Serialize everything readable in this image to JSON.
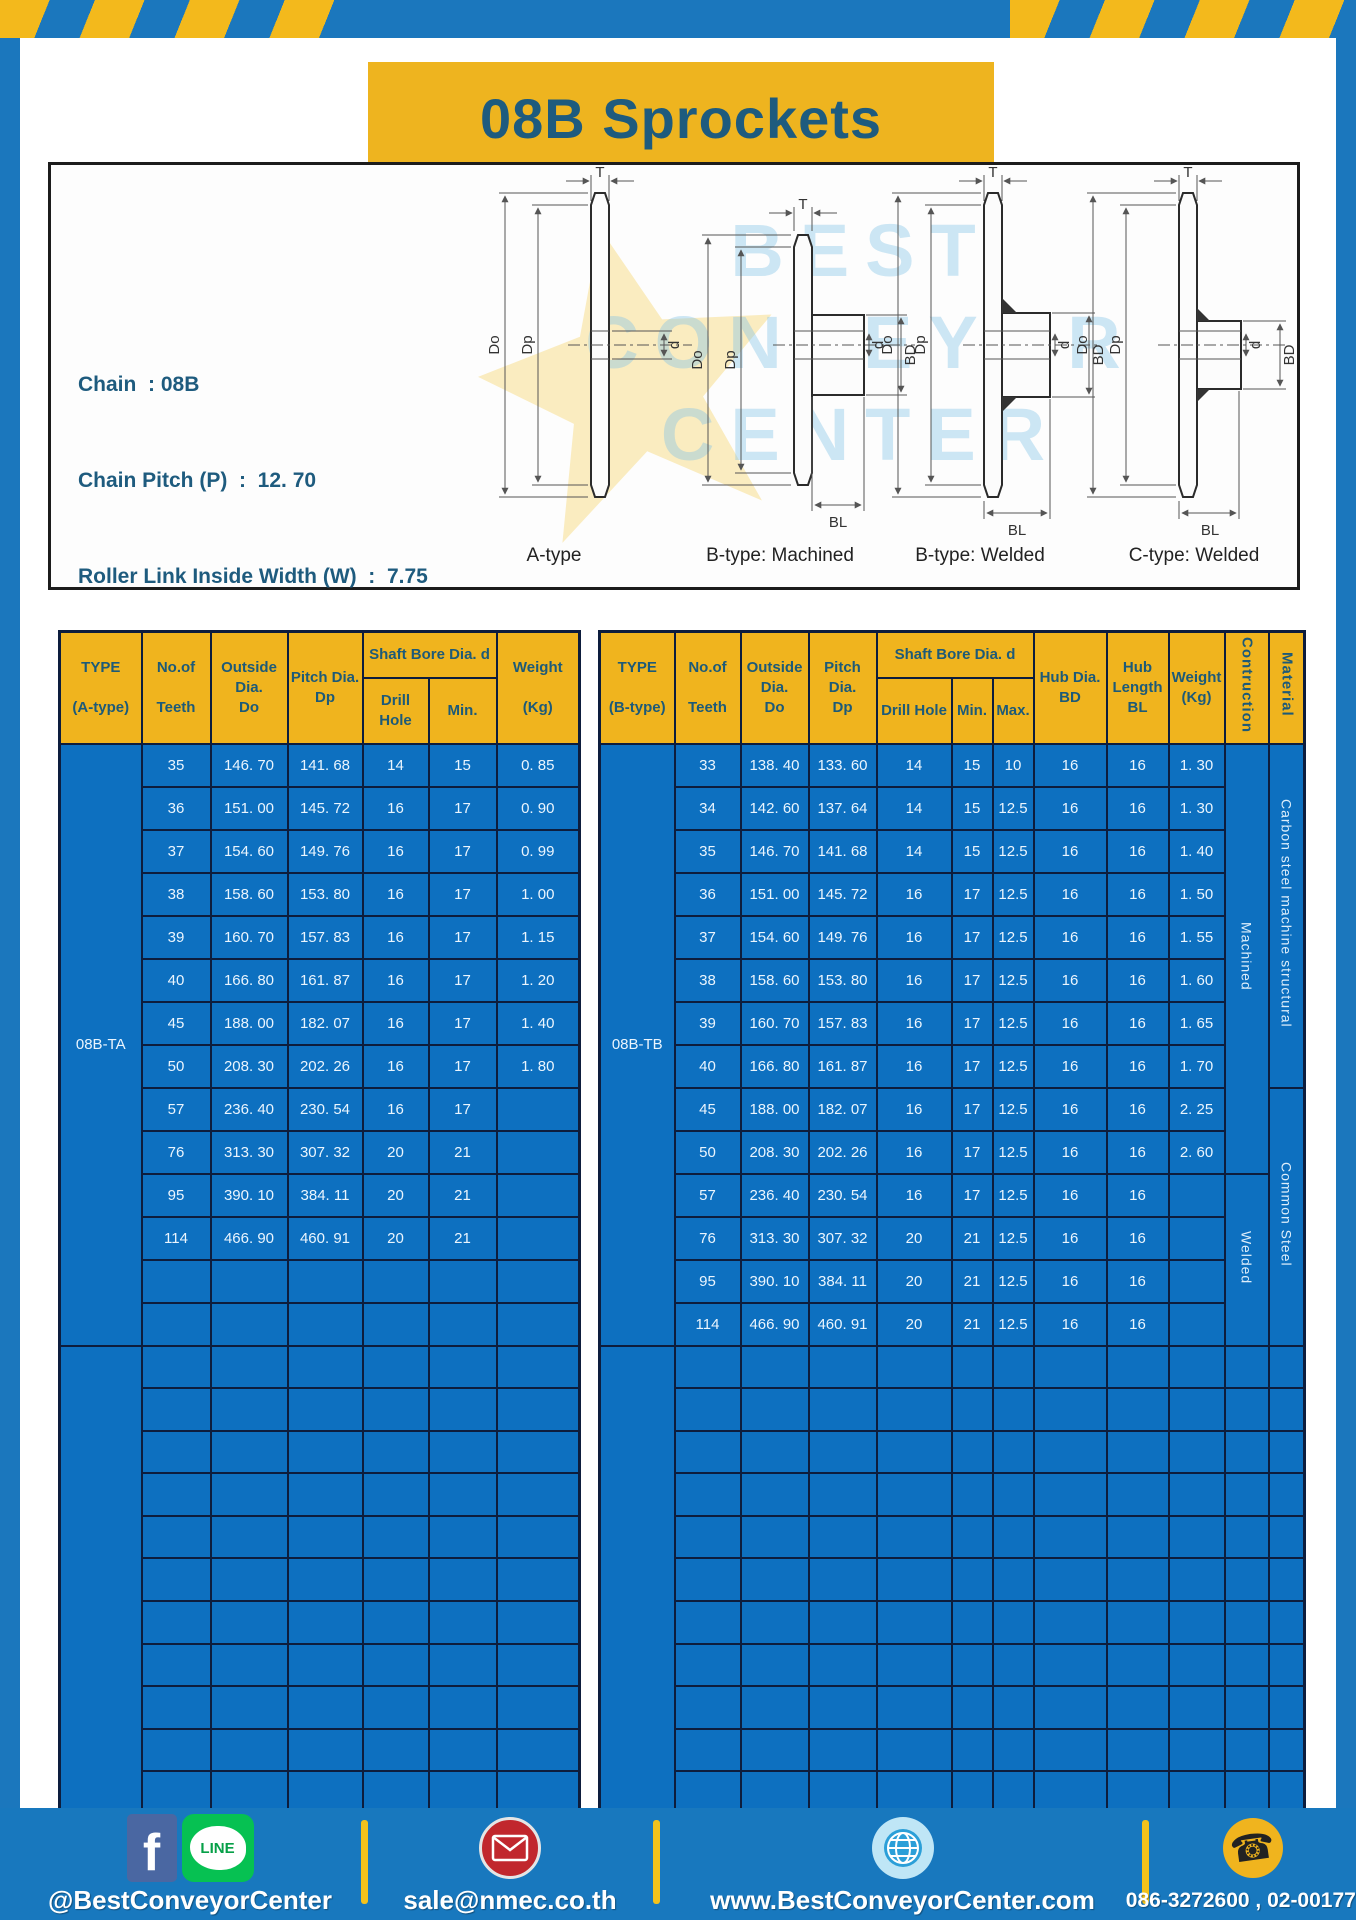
{
  "page": {
    "title": "08B Sprockets"
  },
  "specs": {
    "lines": [
      "Chain  : 08B",
      "Chain Pitch (P)  :  12. 70",
      "Roller Link Inside Width (W)  :  7.75",
      "Roller Diameter (Dr)  : 8.51",
      "Teeth Width (T)  :  7.2"
    ]
  },
  "diagram": {
    "labels": [
      "A-type",
      "B-type: Machined",
      "B-type: Welded",
      "C-type: Welded"
    ],
    "dims": {
      "t": "T",
      "do": "Do",
      "dp": "Dp",
      "d": "d",
      "bd": "BD",
      "bl": "BL"
    },
    "watermark": {
      "line1": "BEST",
      "line2": "CONVEYOR",
      "line3": "CENTER"
    }
  },
  "table_a": {
    "columns": {
      "type": "TYPE\n\n(A-type)",
      "teeth": "No.of\n\nTeeth",
      "outside": "Outside\nDia.\nDo",
      "pitch": "Pitch Dia.\nDp",
      "shaft_bore": "Shaft Bore Dia. d",
      "drill": "Drill Hole",
      "min": "Min.",
      "weight": "Weight\n\n(Kg)"
    },
    "type_value": "08B-TA",
    "rows": [
      {
        "teeth": "35",
        "do": "146. 70",
        "dp": "141. 68",
        "drill": "14",
        "min": "15",
        "weight": "0. 85"
      },
      {
        "teeth": "36",
        "do": "151. 00",
        "dp": "145. 72",
        "drill": "16",
        "min": "17",
        "weight": "0. 90"
      },
      {
        "teeth": "37",
        "do": "154. 60",
        "dp": "149. 76",
        "drill": "16",
        "min": "17",
        "weight": "0. 99"
      },
      {
        "teeth": "38",
        "do": "158. 60",
        "dp": "153. 80",
        "drill": "16",
        "min": "17",
        "weight": "1. 00"
      },
      {
        "teeth": "39",
        "do": "160. 70",
        "dp": "157. 83",
        "drill": "16",
        "min": "17",
        "weight": "1. 15"
      },
      {
        "teeth": "40",
        "do": "166. 80",
        "dp": "161. 87",
        "drill": "16",
        "min": "17",
        "weight": "1. 20"
      },
      {
        "teeth": "45",
        "do": "188. 00",
        "dp": "182. 07",
        "drill": "16",
        "min": "17",
        "weight": "1. 40"
      },
      {
        "teeth": "50",
        "do": "208. 30",
        "dp": "202. 26",
        "drill": "16",
        "min": "17",
        "weight": "1. 80"
      },
      {
        "teeth": "57",
        "do": "236. 40",
        "dp": "230. 54",
        "drill": "16",
        "min": "17",
        "weight": ""
      },
      {
        "teeth": "76",
        "do": "313. 30",
        "dp": "307. 32",
        "drill": "20",
        "min": "21",
        "weight": ""
      },
      {
        "teeth": "95",
        "do": "390. 10",
        "dp": "384. 11",
        "drill": "20",
        "min": "21",
        "weight": ""
      },
      {
        "teeth": "114",
        "do": "466. 90",
        "dp": "460. 91",
        "drill": "20",
        "min": "21",
        "weight": ""
      }
    ]
  },
  "table_b": {
    "columns": {
      "type": "TYPE\n\n(B-type)",
      "teeth": "No.of\n\nTeeth",
      "outside": "Outside\nDia.\nDo",
      "pitch": "Pitch Dia.\nDp",
      "shaft_bore": "Shaft Bore Dia. d",
      "drill": "Drill Hole",
      "min": "Min.",
      "max": "Max.",
      "hub_dia": "Hub Dia.\nBD",
      "hub_length": "Hub\nLength\nBL",
      "weight": "Weight\n(Kg)",
      "construction": "Contruction",
      "material": "Material"
    },
    "type_value": "08B-TB",
    "rows": [
      {
        "teeth": "33",
        "do": "138. 40",
        "dp": "133. 60",
        "drill": "14",
        "min": "15",
        "max": "10",
        "bd": "16",
        "bl": "16",
        "weight": "1. 30"
      },
      {
        "teeth": "34",
        "do": "142. 60",
        "dp": "137. 64",
        "drill": "14",
        "min": "15",
        "max": "12.5",
        "bd": "16",
        "bl": "16",
        "weight": "1. 30"
      },
      {
        "teeth": "35",
        "do": "146. 70",
        "dp": "141. 68",
        "drill": "14",
        "min": "15",
        "max": "12.5",
        "bd": "16",
        "bl": "16",
        "weight": "1. 40"
      },
      {
        "teeth": "36",
        "do": "151. 00",
        "dp": "145. 72",
        "drill": "16",
        "min": "17",
        "max": "12.5",
        "bd": "16",
        "bl": "16",
        "weight": "1. 50"
      },
      {
        "teeth": "37",
        "do": "154. 60",
        "dp": "149. 76",
        "drill": "16",
        "min": "17",
        "max": "12.5",
        "bd": "16",
        "bl": "16",
        "weight": "1. 55"
      },
      {
        "teeth": "38",
        "do": "158. 60",
        "dp": "153. 80",
        "drill": "16",
        "min": "17",
        "max": "12.5",
        "bd": "16",
        "bl": "16",
        "weight": "1. 60"
      },
      {
        "teeth": "39",
        "do": "160. 70",
        "dp": "157. 83",
        "drill": "16",
        "min": "17",
        "max": "12.5",
        "bd": "16",
        "bl": "16",
        "weight": "1. 65"
      },
      {
        "teeth": "40",
        "do": "166. 80",
        "dp": "161. 87",
        "drill": "16",
        "min": "17",
        "max": "12.5",
        "bd": "16",
        "bl": "16",
        "weight": "1. 70"
      },
      {
        "teeth": "45",
        "do": "188. 00",
        "dp": "182. 07",
        "drill": "16",
        "min": "17",
        "max": "12.5",
        "bd": "16",
        "bl": "16",
        "weight": "2. 25"
      },
      {
        "teeth": "50",
        "do": "208. 30",
        "dp": "202. 26",
        "drill": "16",
        "min": "17",
        "max": "12.5",
        "bd": "16",
        "bl": "16",
        "weight": "2. 60"
      },
      {
        "teeth": "57",
        "do": "236. 40",
        "dp": "230. 54",
        "drill": "16",
        "min": "17",
        "max": "12.5",
        "bd": "16",
        "bl": "16",
        "weight": ""
      },
      {
        "teeth": "76",
        "do": "313. 30",
        "dp": "307. 32",
        "drill": "20",
        "min": "21",
        "max": "12.5",
        "bd": "16",
        "bl": "16",
        "weight": ""
      },
      {
        "teeth": "95",
        "do": "390. 10",
        "dp": "384. 11",
        "drill": "20",
        "min": "21",
        "max": "12.5",
        "bd": "16",
        "bl": "16",
        "weight": ""
      },
      {
        "teeth": "114",
        "do": "466. 90",
        "dp": "460. 91",
        "drill": "20",
        "min": "21",
        "max": "12.5",
        "bd": "16",
        "bl": "16",
        "weight": ""
      }
    ],
    "construction_groups": [
      {
        "label": "Machined",
        "span": 10
      },
      {
        "label": "Welded",
        "span": 4
      }
    ],
    "material_groups": [
      {
        "label": "Carbon steel  machine structural",
        "span": 8
      },
      {
        "label": "Common  Steel",
        "span": 6
      }
    ]
  },
  "footer": {
    "facebook_line_text": "@BestConveyorCenter",
    "email_text": "sale@nmec.co.th",
    "web_text": "www.BestConveyorCenter.com",
    "phone_text": "086-3272600 , 02-0017766"
  },
  "colors": {
    "page_blue": "#1b77bd",
    "banner_yellow": "#eeb41f",
    "header_yellow": "#f0b41e",
    "cell_blue": "#0d70c0",
    "grid_navy": "#0d1d3d",
    "title_text": "#1e5b7e"
  }
}
